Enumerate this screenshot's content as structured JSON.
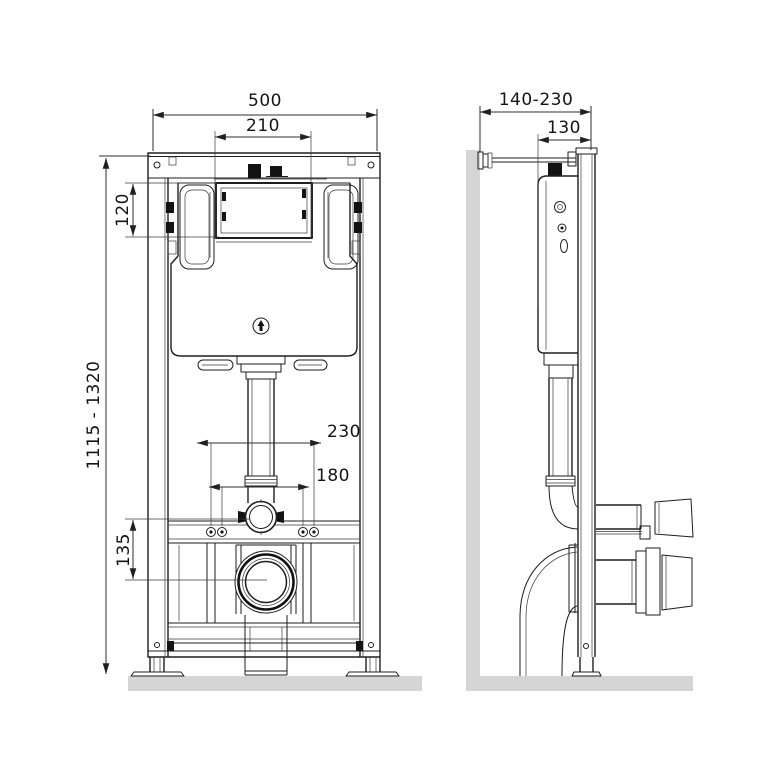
{
  "drawing": {
    "views": {
      "front": "front-view",
      "side": "side-view"
    },
    "dimensions_mm": {
      "front": {
        "frame_width": "500",
        "plate_opening_width": "210",
        "plate_opening_height": "120",
        "installation_height_range": "1115 - 1320",
        "outlet_center_offset": "135",
        "fixing_spacing_outer": "230",
        "fixing_spacing_inner": "180"
      },
      "side": {
        "wall_distance_range": "140-230",
        "frame_depth": "130"
      }
    },
    "colors": {
      "background": "#ffffff",
      "line": "#1e1e1e",
      "dimension_line": "#2e2e2e",
      "surface_gray": "#d5d5d5",
      "accent_black": "#131313"
    }
  }
}
